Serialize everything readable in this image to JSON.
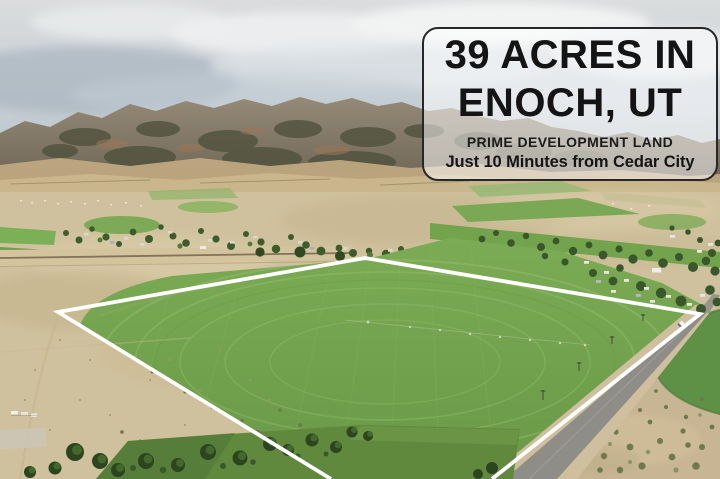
{
  "overlay": {
    "title_line1": "39 ACRES IN",
    "title_line2": "ENOCH, UT",
    "subtitle1": "PRIME DEVELOPMENT LAND",
    "subtitle2": "Just 10 Minutes from Cedar City"
  },
  "scene": {
    "type": "aerial-drone-photo",
    "elements": [
      "sky-with-clouds",
      "mountain-range",
      "foothills",
      "valley-town-with-trees-and-houses",
      "green-pivot-irrigated-field",
      "white-property-boundary-outline",
      "paved-road",
      "dirt-scrub-lots",
      "tree-row",
      "neighboring-pivot-circle-field"
    ]
  },
  "colors": {
    "overlay_fill": "rgba(255,255,255,0.52)",
    "overlay_border": "#272727",
    "overlay_text": "#141414",
    "boundary_line": "#ffffff",
    "field_green": "#72a24c",
    "sky_gray_blue": "#c6cdd3",
    "mountain_brown": "#7c7264",
    "valley_tan": "#cfc19d",
    "road_gray": "#8e8d87"
  }
}
